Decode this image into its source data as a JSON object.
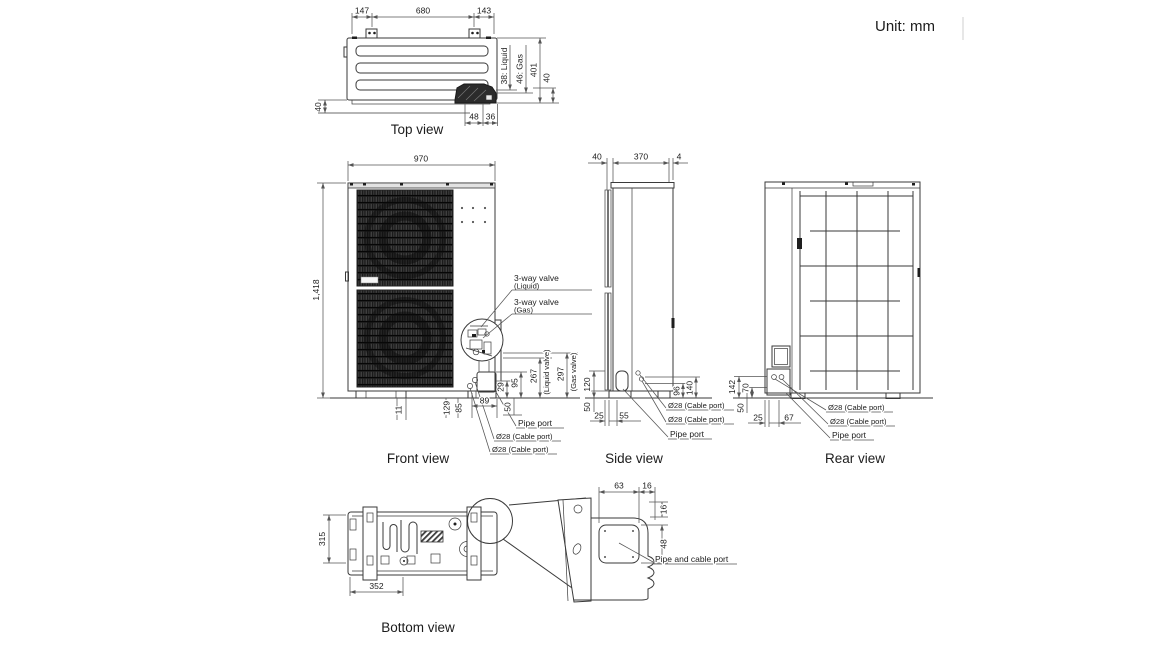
{
  "unit_note": "Unit: mm",
  "views": {
    "top": {
      "label": "Top view",
      "dims": {
        "left_147": "147",
        "mid_680": "680",
        "right_143": "143",
        "left_40": "40",
        "bottom_48": "48",
        "bottom_36": "36",
        "liquid": "38: Liquid",
        "gas": "46: Gas",
        "depth_401": "401",
        "right_40": "40"
      }
    },
    "front": {
      "label": "Front view",
      "dims": {
        "width_970": "970",
        "height_1418": "1,418",
        "d11": "11",
        "d129": "129",
        "d85": "85",
        "d89": "89",
        "d29": "29",
        "d95": "95",
        "d50": "50",
        "d267": "267",
        "liquid_valve_note": "(Liquid valve)",
        "d297": "297",
        "gas_valve_note": "(Gas valve)"
      },
      "callouts": {
        "three_way_liquid": "3-way valve",
        "three_way_liquid_sub": "(Liquid)",
        "three_way_gas": "3-way valve",
        "three_way_gas_sub": "(Gas)",
        "pipe_port": "Pipe port",
        "cable_port_1": "Ø28 (Cable port)",
        "cable_port_2": "Ø28 (Cable port)"
      }
    },
    "side": {
      "label": "Side view",
      "dims": {
        "d40": "40",
        "d370": "370",
        "d4": "4",
        "d120": "120",
        "d50": "50",
        "d25": "25",
        "d55": "55",
        "d96": "96",
        "d140": "140"
      },
      "callouts": {
        "cable_port_1": "Ø28 (Cable port)",
        "cable_port_2": "Ø28 (Cable port)",
        "pipe_port": "Pipe port"
      }
    },
    "rear": {
      "label": "Rear view",
      "dims": {
        "d142": "142",
        "d70": "70",
        "d50": "50",
        "d25": "25",
        "d67": "67"
      },
      "callouts": {
        "cable_port_1": "Ø28 (Cable port)",
        "cable_port_2": "Ø28 (Cable port)",
        "pipe_port": "Pipe port"
      }
    },
    "bottom": {
      "label": "Bottom view",
      "dims": {
        "d315": "315",
        "d352": "352"
      }
    },
    "detail": {
      "dims": {
        "d63": "63",
        "d16_top": "16",
        "d16_right": "16",
        "d48": "48"
      },
      "callouts": {
        "pipe_cable_port": "Pipe and cable port"
      }
    }
  },
  "colors": {
    "background": "#ffffff",
    "line": "#3a3a3a",
    "dimension": "#555555",
    "text": "#1c1c1c"
  }
}
